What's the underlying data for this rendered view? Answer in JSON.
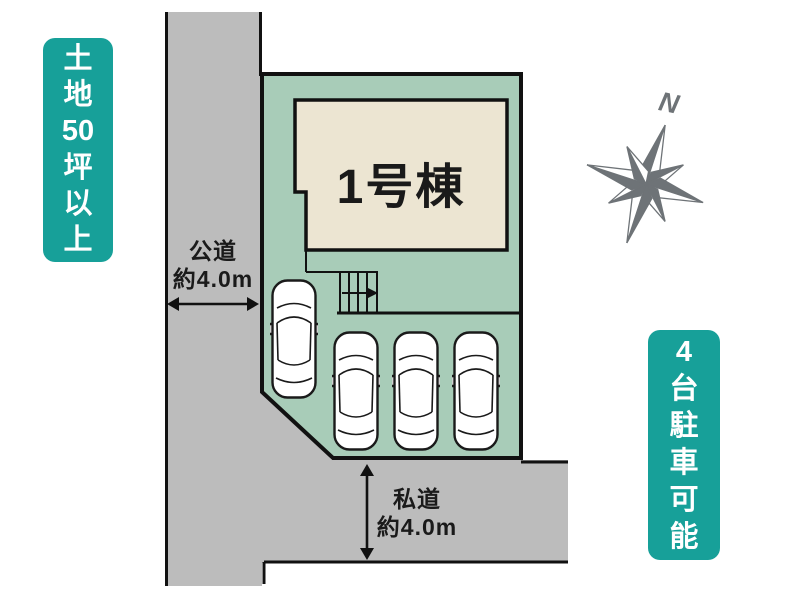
{
  "plot_plan": {
    "building_label": "1号棟",
    "public_road_label": {
      "line1": "公道",
      "line2": "約4.0m"
    },
    "private_road_label": {
      "line1": "私道",
      "line2": "約4.0m"
    },
    "compass": {
      "north_label": "N"
    },
    "parking": {
      "car_count": "4"
    }
  },
  "badges": {
    "left": {
      "text": "土地50坪以上",
      "chars": [
        "土",
        "地",
        "50",
        "坪",
        "以",
        "上"
      ]
    },
    "right": {
      "text": "4台駐車可能",
      "chars": [
        "4",
        "台",
        "駐",
        "車",
        "可",
        "能"
      ]
    }
  },
  "colors": {
    "badge_teal": "#17a099",
    "plot_green": "#a8ccb8",
    "building_beige": "#ece5d2",
    "road_gray": "#bcbcbc",
    "outline": "#111111",
    "compass_gray": "#6e7377",
    "car_white": "#ffffff",
    "text": "#1a1a1a"
  }
}
